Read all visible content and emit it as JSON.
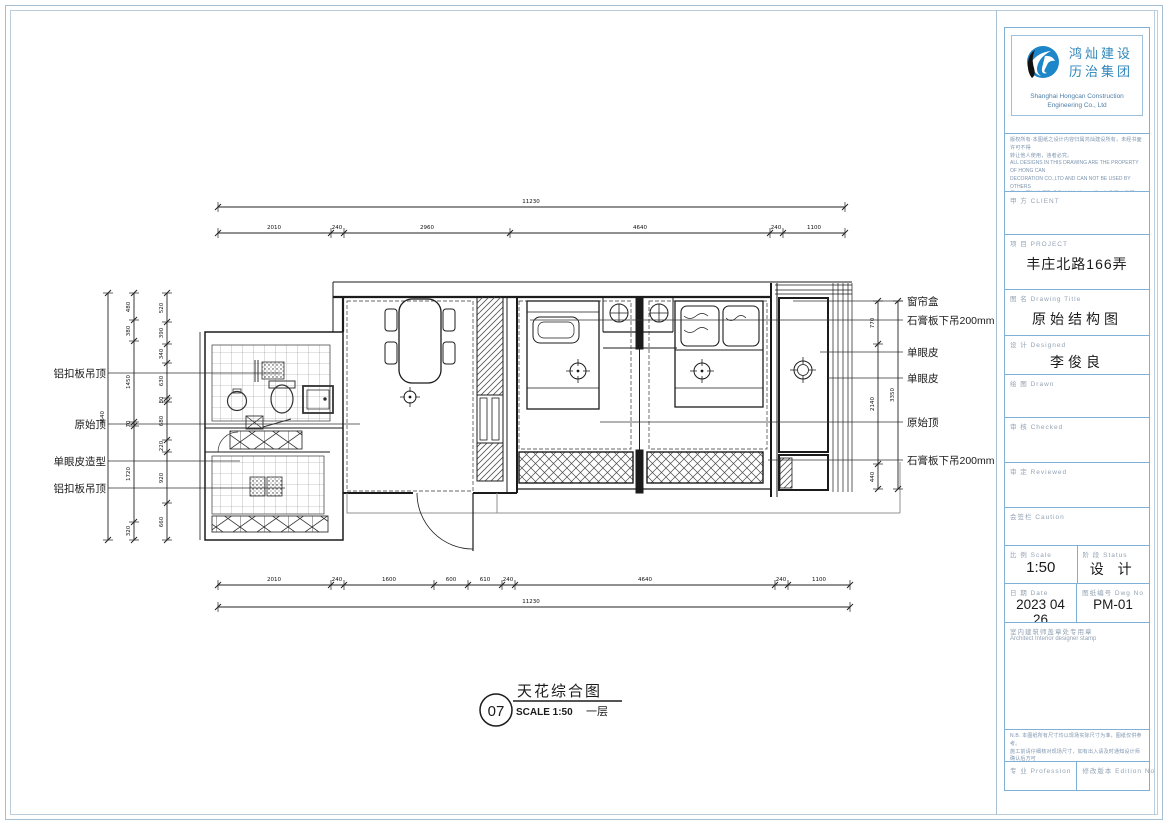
{
  "drawing": {
    "index_number": "07",
    "title": "天花综合图",
    "scale_text": "SCALE 1:50",
    "floor_text": "一层",
    "labels_left": [
      "铝扣板吊顶",
      "原始顶",
      "单眼皮造型",
      "铝扣板吊顶"
    ],
    "labels_right": [
      "窗帘盒",
      "石膏板下吊200mm",
      "单眼皮",
      "单眼皮",
      "原始顶",
      "石膏板下吊200mm"
    ],
    "dims": {
      "top_total": "11230",
      "top_segments": [
        "2010",
        "240",
        "2960",
        "4640",
        "240",
        "1100"
      ],
      "bottom_segments": [
        "2010",
        "240",
        "1600",
        "600",
        "610",
        "240",
        "4640",
        "240",
        "1100"
      ],
      "bottom_total": "11230",
      "left_total": "4540",
      "left_mid": [
        "480",
        "380",
        "1450",
        "70",
        "1720",
        "320"
      ],
      "left_fine": [
        "520",
        "390",
        "340",
        "630",
        "80",
        "680",
        "220",
        "920",
        "660"
      ],
      "right_inner": [
        "770",
        "2140",
        "440"
      ],
      "right_outer": "3350"
    }
  },
  "titleblock": {
    "logo": {
      "cn1": "鸿灿建设",
      "cn2": "历治集团",
      "en1": "Shanghai Hongcan Construction",
      "en2": "Engineering Co., Ltd"
    },
    "notes_top": [
      "版权所有·本图纸之设计内容归属鸿灿建设所有，未经书面许可不得",
      "转让他人使用，违者必究。",
      "ALL DESIGNS IN THIS DRAWING ARE THE PROPERTY OF HONG CAN",
      "DECORATION CO.,LTD AND CAN NOT BE USED BY OTHERS",
      "尺寸以图注数据及现场放样为准，不得以比例尺度量图纸。",
      "DO NOT SCALE DRAWING,ALL DIMENSIONS MUST BE CHECKED AND",
      "VERIFIED ON SITE"
    ],
    "client_label": "甲  方  CLIENT",
    "project_label": "项  目  PROJECT",
    "project_value": "丰庄北路166弄",
    "drawing_title_label": "图  名  Drawing Title",
    "drawing_title_value": "原始结构图",
    "designed_label": "设  计  Designed",
    "designed_value": "李俊良",
    "drawn_label": "绘  图  Drawn",
    "checked_label": "审  核  Checked",
    "reviewed_label": "审  定  Reviewed",
    "caution_label": "会签栏  Caution",
    "scale_label": "比  例  Scale",
    "scale_value": "1:50",
    "status_label": "阶  段  Status",
    "status_value": "设  计",
    "date_label": "日  期  Date",
    "date_value": "2023 04 26",
    "dwgno_label": "图纸编号  Dwg No",
    "dwgno_value": "PM-01",
    "stamp_label_cn": "室内建筑师盖章处专用章",
    "stamp_label_en": "Architect Interior designer stamp",
    "notes_bottom": [
      "N.B. 本图纸所有尺寸均以现场实际尺寸为准，图纸仅供参考。",
      "施工前请仔细核对现场尺寸，如有出入请及时通知设计师 确认后方可",
      "“予以实施施工”，敬请相关单位知悉配合，不得擅自更改。"
    ],
    "profession_label": "专  业  Profession",
    "edition_label": "修改版本  Edition No"
  }
}
